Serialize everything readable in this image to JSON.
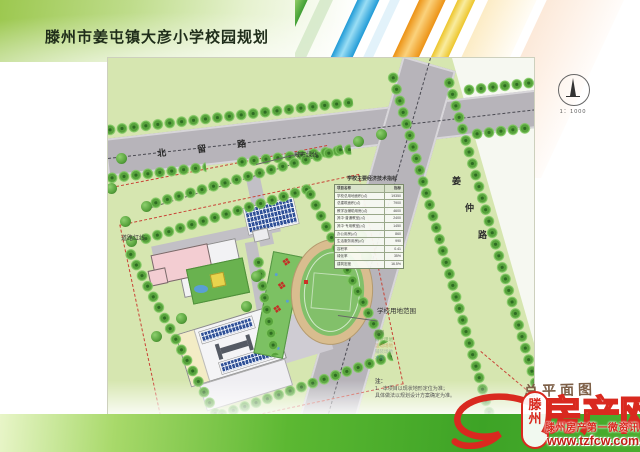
{
  "header": {
    "title": "滕州市姜屯镇大彦小学校园规划"
  },
  "plan": {
    "road_north": {
      "name": "北留路",
      "chars": [
        "北",
        "留",
        "路"
      ]
    },
    "road_east": {
      "name": "姜仲路",
      "chars": [
        "姜",
        "仲",
        "路"
      ]
    },
    "labels": {
      "green_line": "城市绿线",
      "road_red_line": "道路红线",
      "site_boundary": "学校用地范围"
    },
    "scale": "1：1000",
    "plan_name": "总平面图",
    "table": {
      "title": "学校主要经济技术指标",
      "col_item": "项目名称",
      "col_value": "指标",
      "rows": [
        [
          "学校总用地面积(㎡)",
          "19350"
        ],
        [
          "总建筑面积(㎡)",
          "7900"
        ],
        [
          "教学及辅助用房(㎡)",
          "4600"
        ],
        [
          "其中·普通教室(㎡)",
          "2400"
        ],
        [
          "其中·专用教室(㎡)",
          "1450"
        ],
        [
          "办公用房(㎡)",
          "860"
        ],
        [
          "生活服务用房(㎡)",
          "990"
        ],
        [
          "容积率",
          "0.41"
        ],
        [
          "绿化率",
          "35%"
        ],
        [
          "建筑密度",
          "16.5%"
        ]
      ]
    },
    "legend": {
      "title": "图例",
      "items": [
        {
          "label": "绿化用地",
          "color": "#4a8f3d"
        },
        {
          "label": "运动场地",
          "color": "#c9833a"
        },
        {
          "label": "铺装场地",
          "color": "#7a8ba0"
        },
        {
          "label": "水面",
          "color": "#4a79b5"
        }
      ]
    },
    "notes": {
      "label": "注：",
      "lines": [
        "1、本项目以现状地形定位为准；",
        "具体做法以规划设计方案确定为准。"
      ]
    }
  },
  "icons": {
    "flower": "❖"
  },
  "watermark": {
    "city_chars": [
      "滕",
      "州"
    ],
    "brand_chars": [
      "房",
      "产",
      "网"
    ],
    "tagline": "滕州房产第一微资讯",
    "url": "www.tzfcw.com.cn"
  },
  "colors": {
    "accent_red": "#d9291f",
    "site_green": "#d6e6b0",
    "road_gray": "#b7b4ba",
    "footer_green": "#4aad2e",
    "track_tan": "#d9bd8f",
    "field_green": "#82c06a"
  }
}
